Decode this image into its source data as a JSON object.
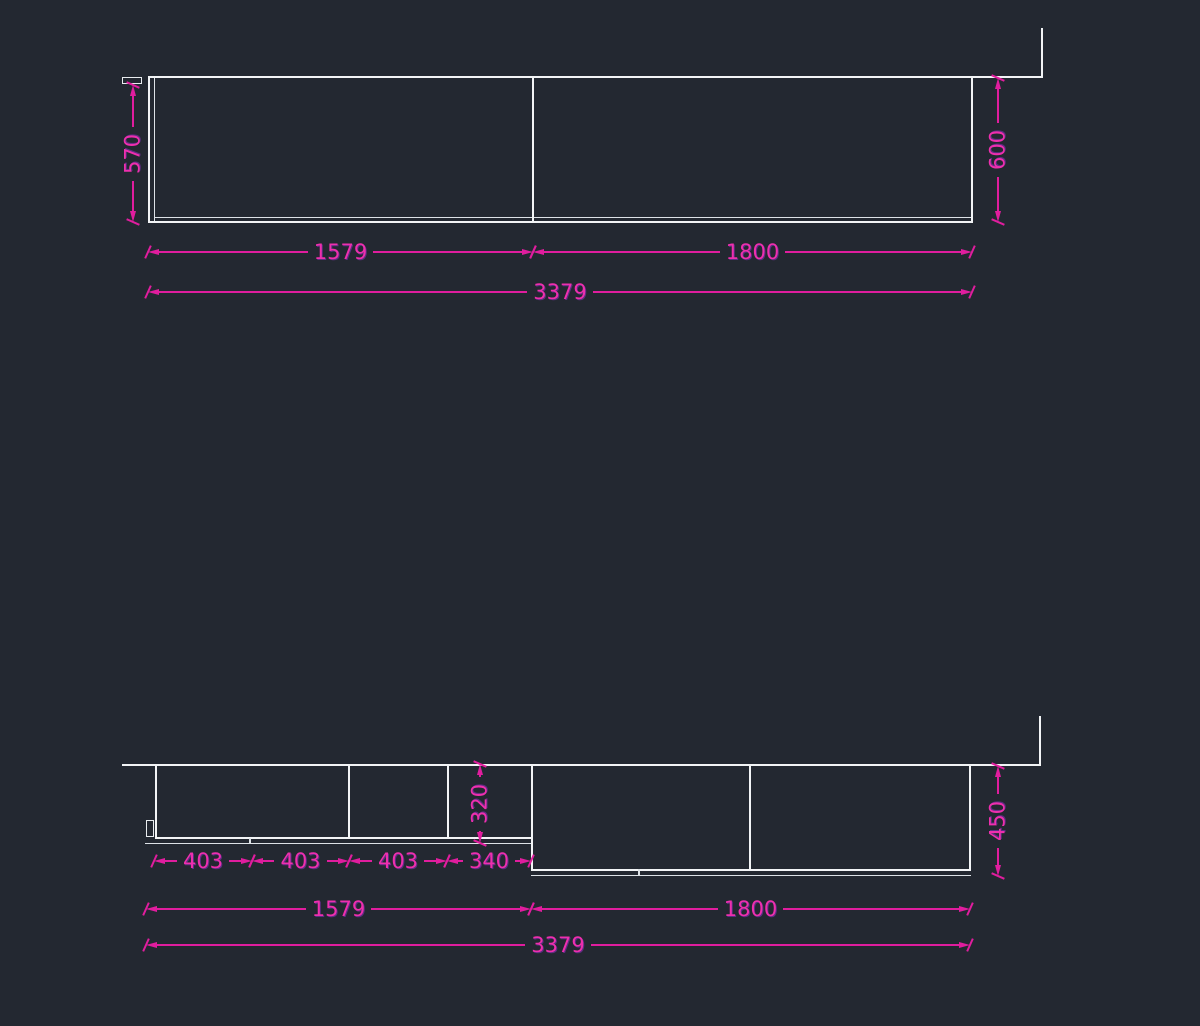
{
  "colors": {
    "background": "#232831",
    "geometry": "#f2f4f6",
    "dimension": "#e01d9e"
  },
  "top_view": {
    "dim_depth_left": "570",
    "dim_depth_right": "600",
    "dim_width_left": "1579",
    "dim_width_right": "1800",
    "dim_width_total": "3379"
  },
  "bottom_view": {
    "dim_doors": [
      "403",
      "403",
      "403",
      "340"
    ],
    "dim_depth_mid": "320",
    "dim_depth_right": "450",
    "dim_width_left": "1579",
    "dim_width_right": "1800",
    "dim_width_total": "3379"
  }
}
